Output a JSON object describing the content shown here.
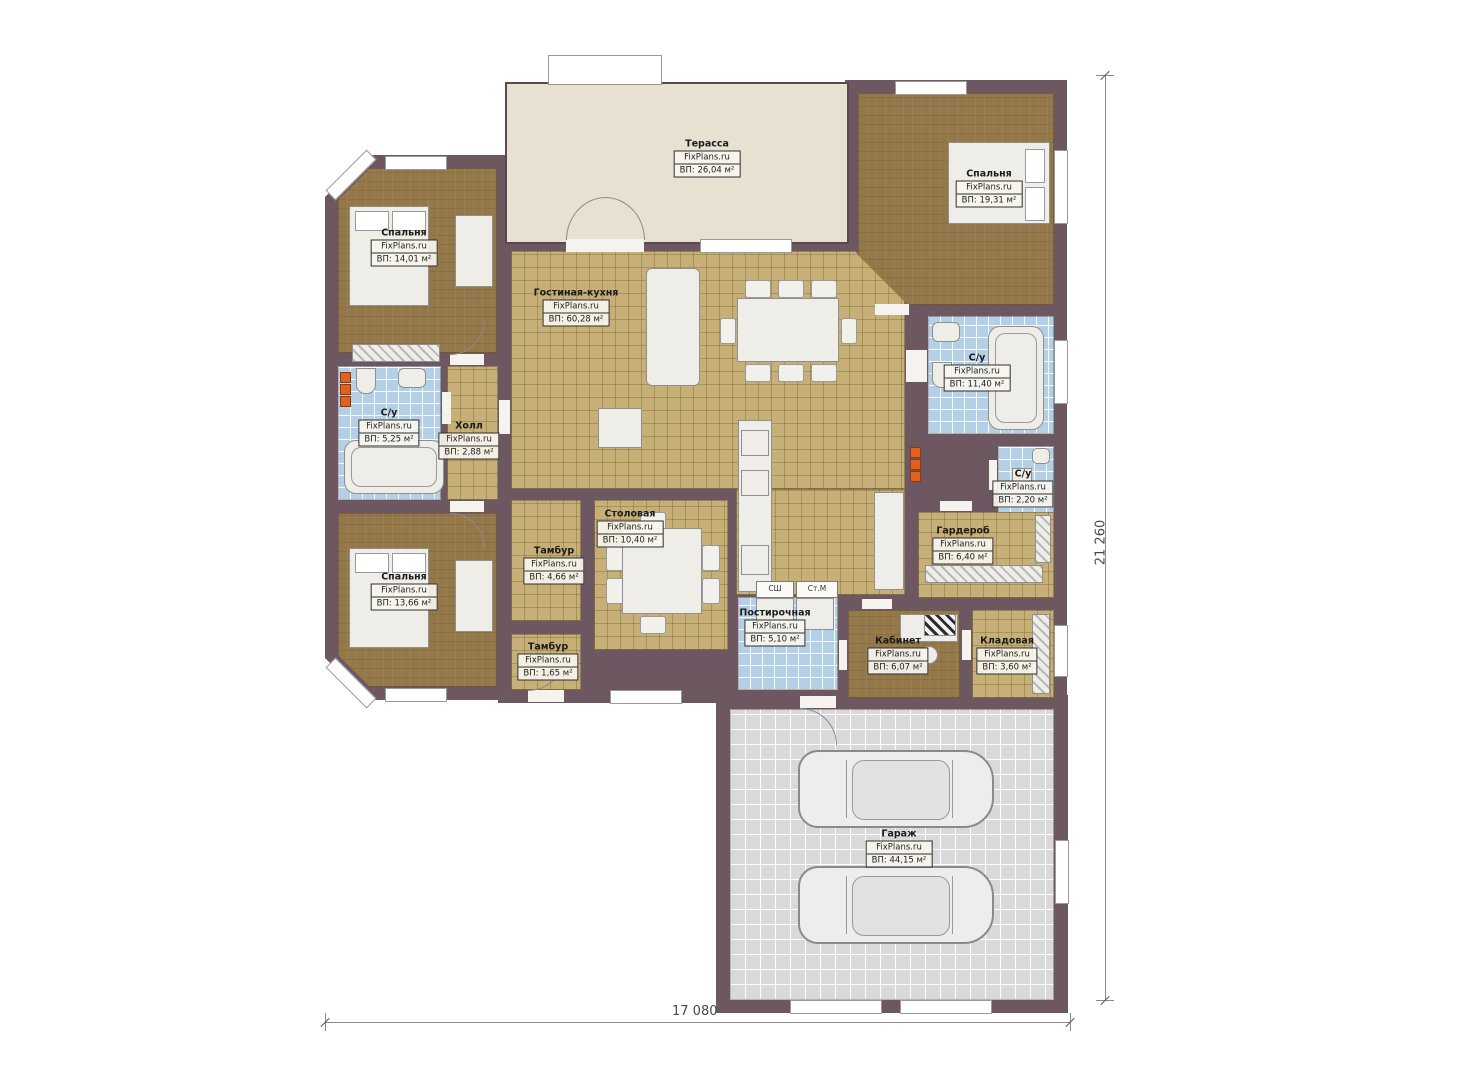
{
  "brand": "FixPlans.ru",
  "rooms": [
    {
      "name": "Терасса",
      "brand": "FixPlans.ru",
      "area": "ВП: 26,04 м²"
    },
    {
      "name": "Спальня",
      "brand": "FixPlans.ru",
      "area": "ВП: 19,31 м²"
    },
    {
      "name": "Спальня",
      "brand": "FixPlans.ru",
      "area": "ВП: 14,01 м²"
    },
    {
      "name": "Гостиная-кухня",
      "brand": "FixPlans.ru",
      "area": "ВП: 60,28 м²"
    },
    {
      "name": "С/у",
      "brand": "FixPlans.ru",
      "area": "ВП: 11,40 м²"
    },
    {
      "name": "С/у",
      "brand": "FixPlans.ru",
      "area": "ВП: 5,25 м²"
    },
    {
      "name": "Холл",
      "brand": "FixPlans.ru",
      "area": "ВП: 2,88 м²"
    },
    {
      "name": "С/у",
      "brand": "FixPlans.ru",
      "area": "ВП: 2,20 м²"
    },
    {
      "name": "Гардероб",
      "brand": "FixPlans.ru",
      "area": "ВП: 6,40 м²"
    },
    {
      "name": "Столовая",
      "brand": "FixPlans.ru",
      "area": "ВП: 10,40 м²"
    },
    {
      "name": "Тамбур",
      "brand": "FixPlans.ru",
      "area": "ВП: 4,66 м²"
    },
    {
      "name": "Спальня",
      "brand": "FixPlans.ru",
      "area": "ВП: 13,66 м²"
    },
    {
      "name": "Постирочная",
      "brand": "FixPlans.ru",
      "area": "ВП: 5,10 м²"
    },
    {
      "name": "Тамбур",
      "brand": "FixPlans.ru",
      "area": "ВП: 1,65 м²"
    },
    {
      "name": "Кабинет",
      "brand": "FixPlans.ru",
      "area": "ВП: 6,07 м²"
    },
    {
      "name": "Кладовая",
      "brand": "FixPlans.ru",
      "area": "ВП: 3,60 м²"
    },
    {
      "name": "Гараж",
      "brand": "FixPlans.ru",
      "area": "ВП: 44,15 м²"
    }
  ],
  "appliances": {
    "dryer": "СШ",
    "washer": "Ст.М"
  },
  "dimensions": {
    "width_label": "17 080",
    "height_label": "21 260"
  },
  "colors": {
    "wall": "#6d5761",
    "tile_floor": "#c6b078",
    "bedroom_floor": "#94784a",
    "bathroom_floor": "#b3d0e7",
    "terrace_floor": "#e8e0d0",
    "garage_floor": "#d9d9d9",
    "accent_orange": "#e2611c"
  }
}
